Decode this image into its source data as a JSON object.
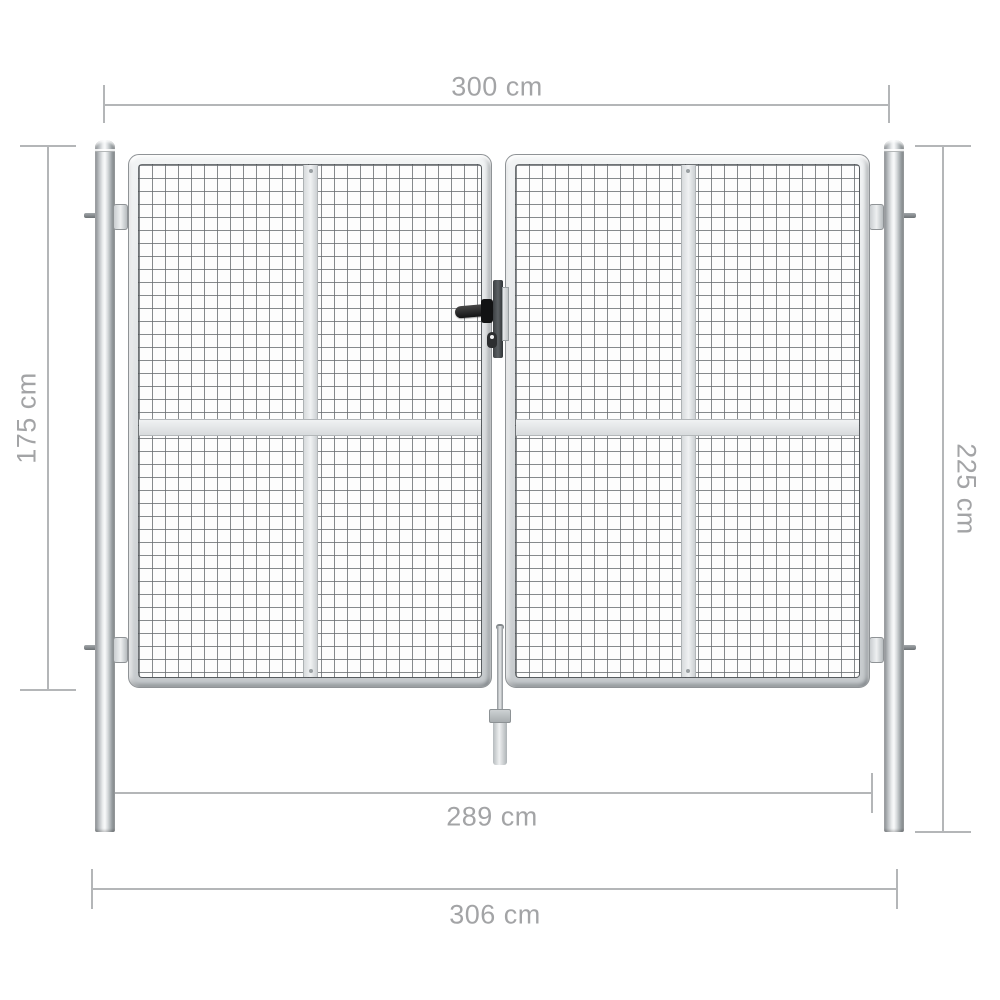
{
  "dimensions": {
    "top_width": "300 cm",
    "gate_height": "175 cm",
    "post_height": "225 cm",
    "inner_width": "289 cm",
    "outer_width": "306 cm"
  },
  "colors": {
    "bg": "#ffffff",
    "dimension_line": "#b4b6b8",
    "dimension_text": "#a3a4a6",
    "metal_light": "#f2f4f5",
    "metal_mid": "#c6cacd",
    "metal_border": "#8f9396",
    "bar_fill": "#f0f2f3",
    "lock_black": "#121314"
  }
}
